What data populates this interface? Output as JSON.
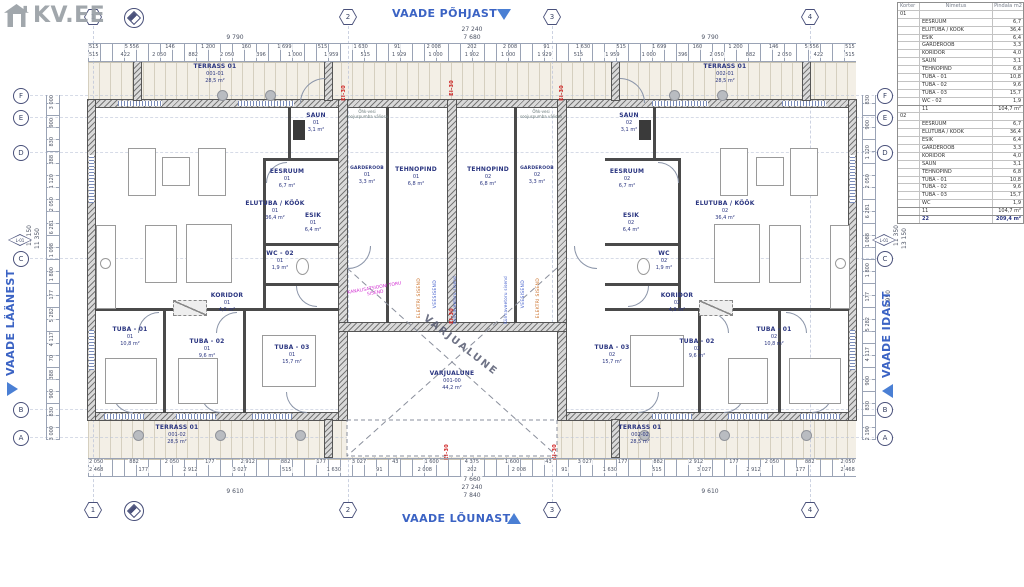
{
  "brand": {
    "logo_text": "KV.EE"
  },
  "views": {
    "north": "VAADE PÕHJAST",
    "south": "VAADE LÕUNAST",
    "west": "VAADE LÄÄNEST",
    "east": "VAADE IDAST"
  },
  "grid_axes": {
    "columns": [
      "1",
      "2",
      "3",
      "4"
    ],
    "rows": [
      "F",
      "E",
      "D",
      "C",
      "B",
      "A"
    ],
    "level_marker": "L-01"
  },
  "area_table": {
    "headers": [
      "Korter",
      "Nimetus",
      "Pindala m2"
    ],
    "apartment1_label": "01",
    "apartment1_rows": [
      [
        "EESRUUM",
        "6,7"
      ],
      [
        "ELUTUBA / KÖÖK",
        "36,4"
      ],
      [
        "ESIK",
        "6,4"
      ],
      [
        "GARDEROOB",
        "3,3"
      ],
      [
        "KORIDOR",
        "4,0"
      ],
      [
        "SAUN",
        "3,1"
      ],
      [
        "TEHNOPIND",
        "6,8"
      ],
      [
        "TUBA - 01",
        "10,8"
      ],
      [
        "TUBA - 02",
        "9,6"
      ],
      [
        "TUBA - 03",
        "15,7"
      ],
      [
        "WC - 02",
        "1,9"
      ]
    ],
    "apartment1_subtotal": [
      "11",
      "104,7 m²"
    ],
    "apartment2_label": "02",
    "apartment2_rows": [
      [
        "EESRUUM",
        "6,7"
      ],
      [
        "ELUTUBA / KÖÖK",
        "36,4"
      ],
      [
        "ESIK",
        "6,4"
      ],
      [
        "GARDEROOB",
        "3,3"
      ],
      [
        "KORIDOR",
        "4,0"
      ],
      [
        "SAUN",
        "3,1"
      ],
      [
        "TEHNOPIND",
        "6,8"
      ],
      [
        "TUBA - 01",
        "10,8"
      ],
      [
        "TUBA - 02",
        "9,6"
      ],
      [
        "TUBA - 03",
        "15,7"
      ],
      [
        "WC",
        "1,9"
      ]
    ],
    "apartment2_subtotal": [
      "11",
      "104,7 m²"
    ],
    "total": [
      "22",
      "209,4 m²"
    ]
  },
  "rooms_left": [
    {
      "name": "ELUTUBA / KÖÖK",
      "id": "01",
      "area": "36,4 m²"
    },
    {
      "name": "EESRUUM",
      "id": "01",
      "area": "6,7 m²"
    },
    {
      "name": "SAUN",
      "id": "01",
      "area": "3,1 m²"
    },
    {
      "name": "ESIK",
      "id": "01",
      "area": "6,4 m²"
    },
    {
      "name": "WC - 02",
      "id": "01",
      "area": "1,9 m²"
    },
    {
      "name": "GARDEROOB",
      "id": "01",
      "area": "3,3 m²"
    },
    {
      "name": "TEHNOPIND",
      "id": "01",
      "area": "6,8 m²"
    },
    {
      "name": "KORIDOR",
      "id": "01",
      "area": "4,0 m²"
    },
    {
      "name": "TUBA - 01",
      "id": "01",
      "area": "10,8 m²"
    },
    {
      "name": "TUBA - 02",
      "id": "01",
      "area": "9,6 m²"
    },
    {
      "name": "TUBA - 03",
      "id": "01",
      "area": "15,7 m²"
    },
    {
      "name": "TERRASS 01",
      "id": "001-01",
      "area": "28,5 m²"
    },
    {
      "name": "TERRASS 01",
      "id": "001-02",
      "area": "28,5 m²"
    }
  ],
  "rooms_right": [
    {
      "name": "ELUTUBA / KÖÖK",
      "id": "02",
      "area": "36,4 m²"
    },
    {
      "name": "EESRUUM",
      "id": "02",
      "area": "6,7 m²"
    },
    {
      "name": "SAUN",
      "id": "02",
      "area": "3,1 m²"
    },
    {
      "name": "ESIK",
      "id": "02",
      "area": "6,4 m²"
    },
    {
      "name": "WC",
      "id": "02",
      "area": "1,9 m²"
    },
    {
      "name": "GARDEROOB",
      "id": "02",
      "area": "3,3 m²"
    },
    {
      "name": "TEHNOPIND",
      "id": "02",
      "area": "6,8 m²"
    },
    {
      "name": "KORIDOR",
      "id": "02",
      "area": "4,9 m²"
    },
    {
      "name": "TUBA - 01",
      "id": "02",
      "area": "10,8 m²"
    },
    {
      "name": "TUBA - 02",
      "id": "02",
      "area": "9,6 m²"
    },
    {
      "name": "TUBA - 03",
      "id": "02",
      "area": "15,7 m²"
    },
    {
      "name": "TERRASS 01",
      "id": "002-01",
      "area": "28,5 m²"
    },
    {
      "name": "TERRASS 01",
      "id": "002-02",
      "area": "28,5 m²"
    }
  ],
  "carport": {
    "name": "VARJUALUNE",
    "id": "001-00",
    "area": "44,2 m²",
    "watermark": "VARJUALUNE"
  },
  "annotations": {
    "fire_rating": "EI-30",
    "sewer_entry": "KANALISATSIOONI TORU SISEND",
    "electric_entry": "ELEKTRI SISEND",
    "water_entry": "VEESISEND",
    "cold_water": "Külmaveetoru sisend",
    "heat_pump": "Õhk-vesi soojuspumba väliosa"
  },
  "dimensions": {
    "top_total": "27 240",
    "top_sub": "7 680",
    "top_side_left": "9 790",
    "top_side_right": "9 790",
    "top_row3": [
      "515",
      "5 556",
      "146",
      "1 200",
      "160",
      "1 699",
      "515",
      "1 630",
      "91",
      "2 008",
      "202",
      "2 008",
      "91",
      "1 630",
      "515",
      "1 699",
      "160",
      "1 200",
      "146",
      "5 556",
      "515"
    ],
    "top_row4": [
      "515",
      "422",
      "2 050",
      "882",
      "2 050",
      "396",
      "1 000",
      "1 959",
      "515",
      "1 929",
      "1 000",
      "1 902",
      "1 000",
      "1 929",
      "515",
      "1 959",
      "1 000",
      "396",
      "2 050",
      "882",
      "2 050",
      "422",
      "515"
    ],
    "bottom_row1": [
      "2 050",
      "882",
      "2 050",
      "177",
      "2 912",
      "882",
      "177",
      "3 027",
      "43",
      "1 600",
      "4 375",
      "1 600",
      "43",
      "3 027",
      "177",
      "882",
      "2 912",
      "177",
      "2 050",
      "882",
      "2 050"
    ],
    "bottom_row2": [
      "2 468",
      "177",
      "2 912",
      "3 027",
      "515",
      "1 630",
      "91",
      "2 008",
      "202",
      "2 008",
      "91",
      "1 630",
      "515",
      "3 027",
      "2 912",
      "177",
      "2 468"
    ],
    "bottom_sub": "7 660",
    "bottom_total": "27 240",
    "bottom_width": "7 840",
    "bottom_side_left": "9 610",
    "bottom_side_right": "9 610",
    "left_total1": "13 150",
    "left_total2": "11 350",
    "left_small": [
      "3 000",
      "900",
      "830",
      "388",
      "1 120",
      "2 050",
      "6 281",
      "1 098",
      "1 800",
      "177",
      "5 282",
      "4 117",
      "70",
      "388",
      "900",
      "830",
      "3 000"
    ],
    "right_total1": "11 350",
    "right_total2": "13 150",
    "right_sub": "5 950",
    "right_small": [
      "830",
      "900",
      "1 120",
      "2 050",
      "6 281",
      "1 088",
      "1 800",
      "177",
      "5 282",
      "4 117",
      "900",
      "830",
      "2 190"
    ]
  },
  "colors": {
    "view_label": "#3b63c4",
    "fire": "#cf2020",
    "sewer": "#d12bd1",
    "electric": "#c96a1f",
    "water": "#3a57c9"
  }
}
